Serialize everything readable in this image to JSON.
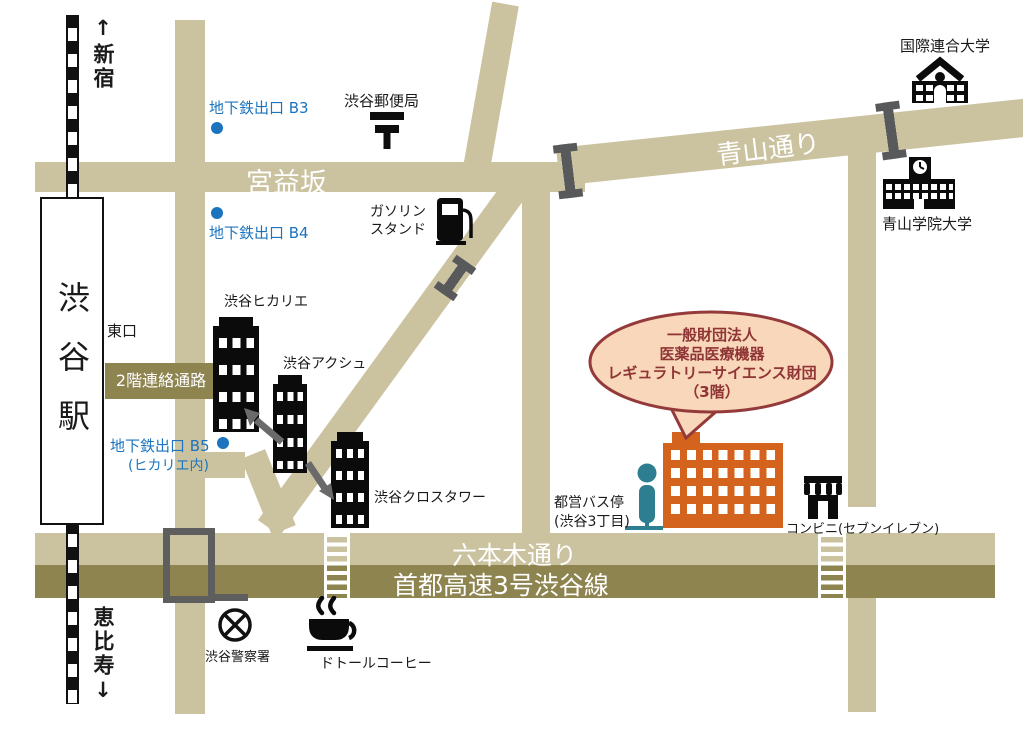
{
  "title": "渋谷駅周辺アクセスマップ",
  "directions": {
    "north": "↑新宿",
    "south": "恵比寿↓"
  },
  "station": {
    "name": "渋谷駅",
    "east_exit": "東口",
    "passage": "2階連絡通路"
  },
  "subway": {
    "b3": "地下鉄出口 B3",
    "b4": "地下鉄出口 B4",
    "b5": "地下鉄出口 B5",
    "b5_note": "(ヒカリエ内)"
  },
  "roads": {
    "miyamasuzaka": "宮益坂",
    "aoyama_dori": "青山通り",
    "roppongi_dori": "六本木通り",
    "expressway": "首都高速3号渋谷線"
  },
  "buildings": {
    "hikarie": "渋谷ヒカリエ",
    "axsh": "渋谷アクシュ",
    "cross_tower": "渋谷クロスタワー"
  },
  "landmarks": {
    "post_office": "渋谷郵便局",
    "gas_line1": "ガソリン",
    "gas_line2": "スタンド",
    "un_university": "国際連合大学",
    "aoyama_gakuin": "青山学院大学",
    "bus_stop": "都営バス停",
    "bus_stop_note": "(渋谷3丁目)",
    "conbini": "コンビニ(セブンイレブン)",
    "police": "渋谷警察署",
    "doutor": "ドトールコーヒー"
  },
  "destination": {
    "line1": "一般財団法人",
    "line2": "医薬品医療機器",
    "line3": "レギュラトリーサイエンス財団",
    "line4": "（3階）"
  },
  "colors": {
    "road": "#cbc3a0",
    "road_dark": "#8e8450",
    "subway_blue": "#1b74bd",
    "bus_teal": "#2e7e92",
    "destination_orange": "#d4631d",
    "bubble_fill": "#f9d7ba",
    "bubble_border": "#953a3a",
    "mark_gray": "#5e5e5e"
  }
}
